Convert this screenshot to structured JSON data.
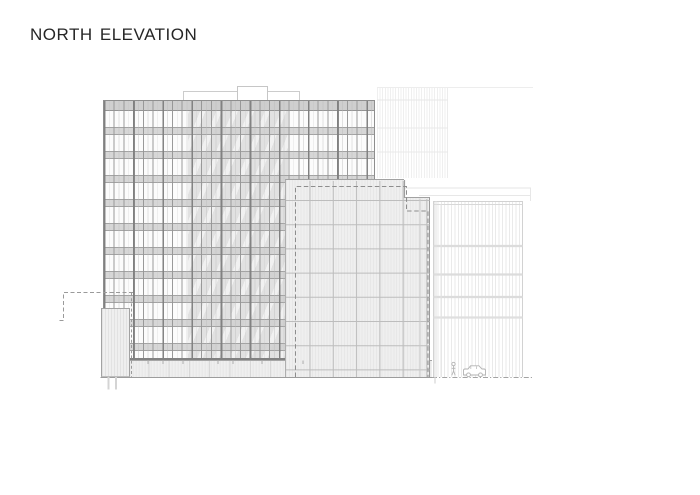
{
  "page": {
    "width": 700,
    "height": 495,
    "background": "#ffffff"
  },
  "header": {
    "title": "NORTH ELEVATION"
  },
  "palette": {
    "ink": "#262626",
    "strong_line": "#8a8a8a",
    "medium_line": "#b5b5b5",
    "light_line": "#d6d6d6",
    "faint_line": "#ececec",
    "panel_fill": "#efefef",
    "glass_shade": "#e1e1e1",
    "spandrel": "#d0d0d0"
  },
  "figures": {
    "pedestrian": "pedestrian-figure",
    "car": "car-figure"
  }
}
